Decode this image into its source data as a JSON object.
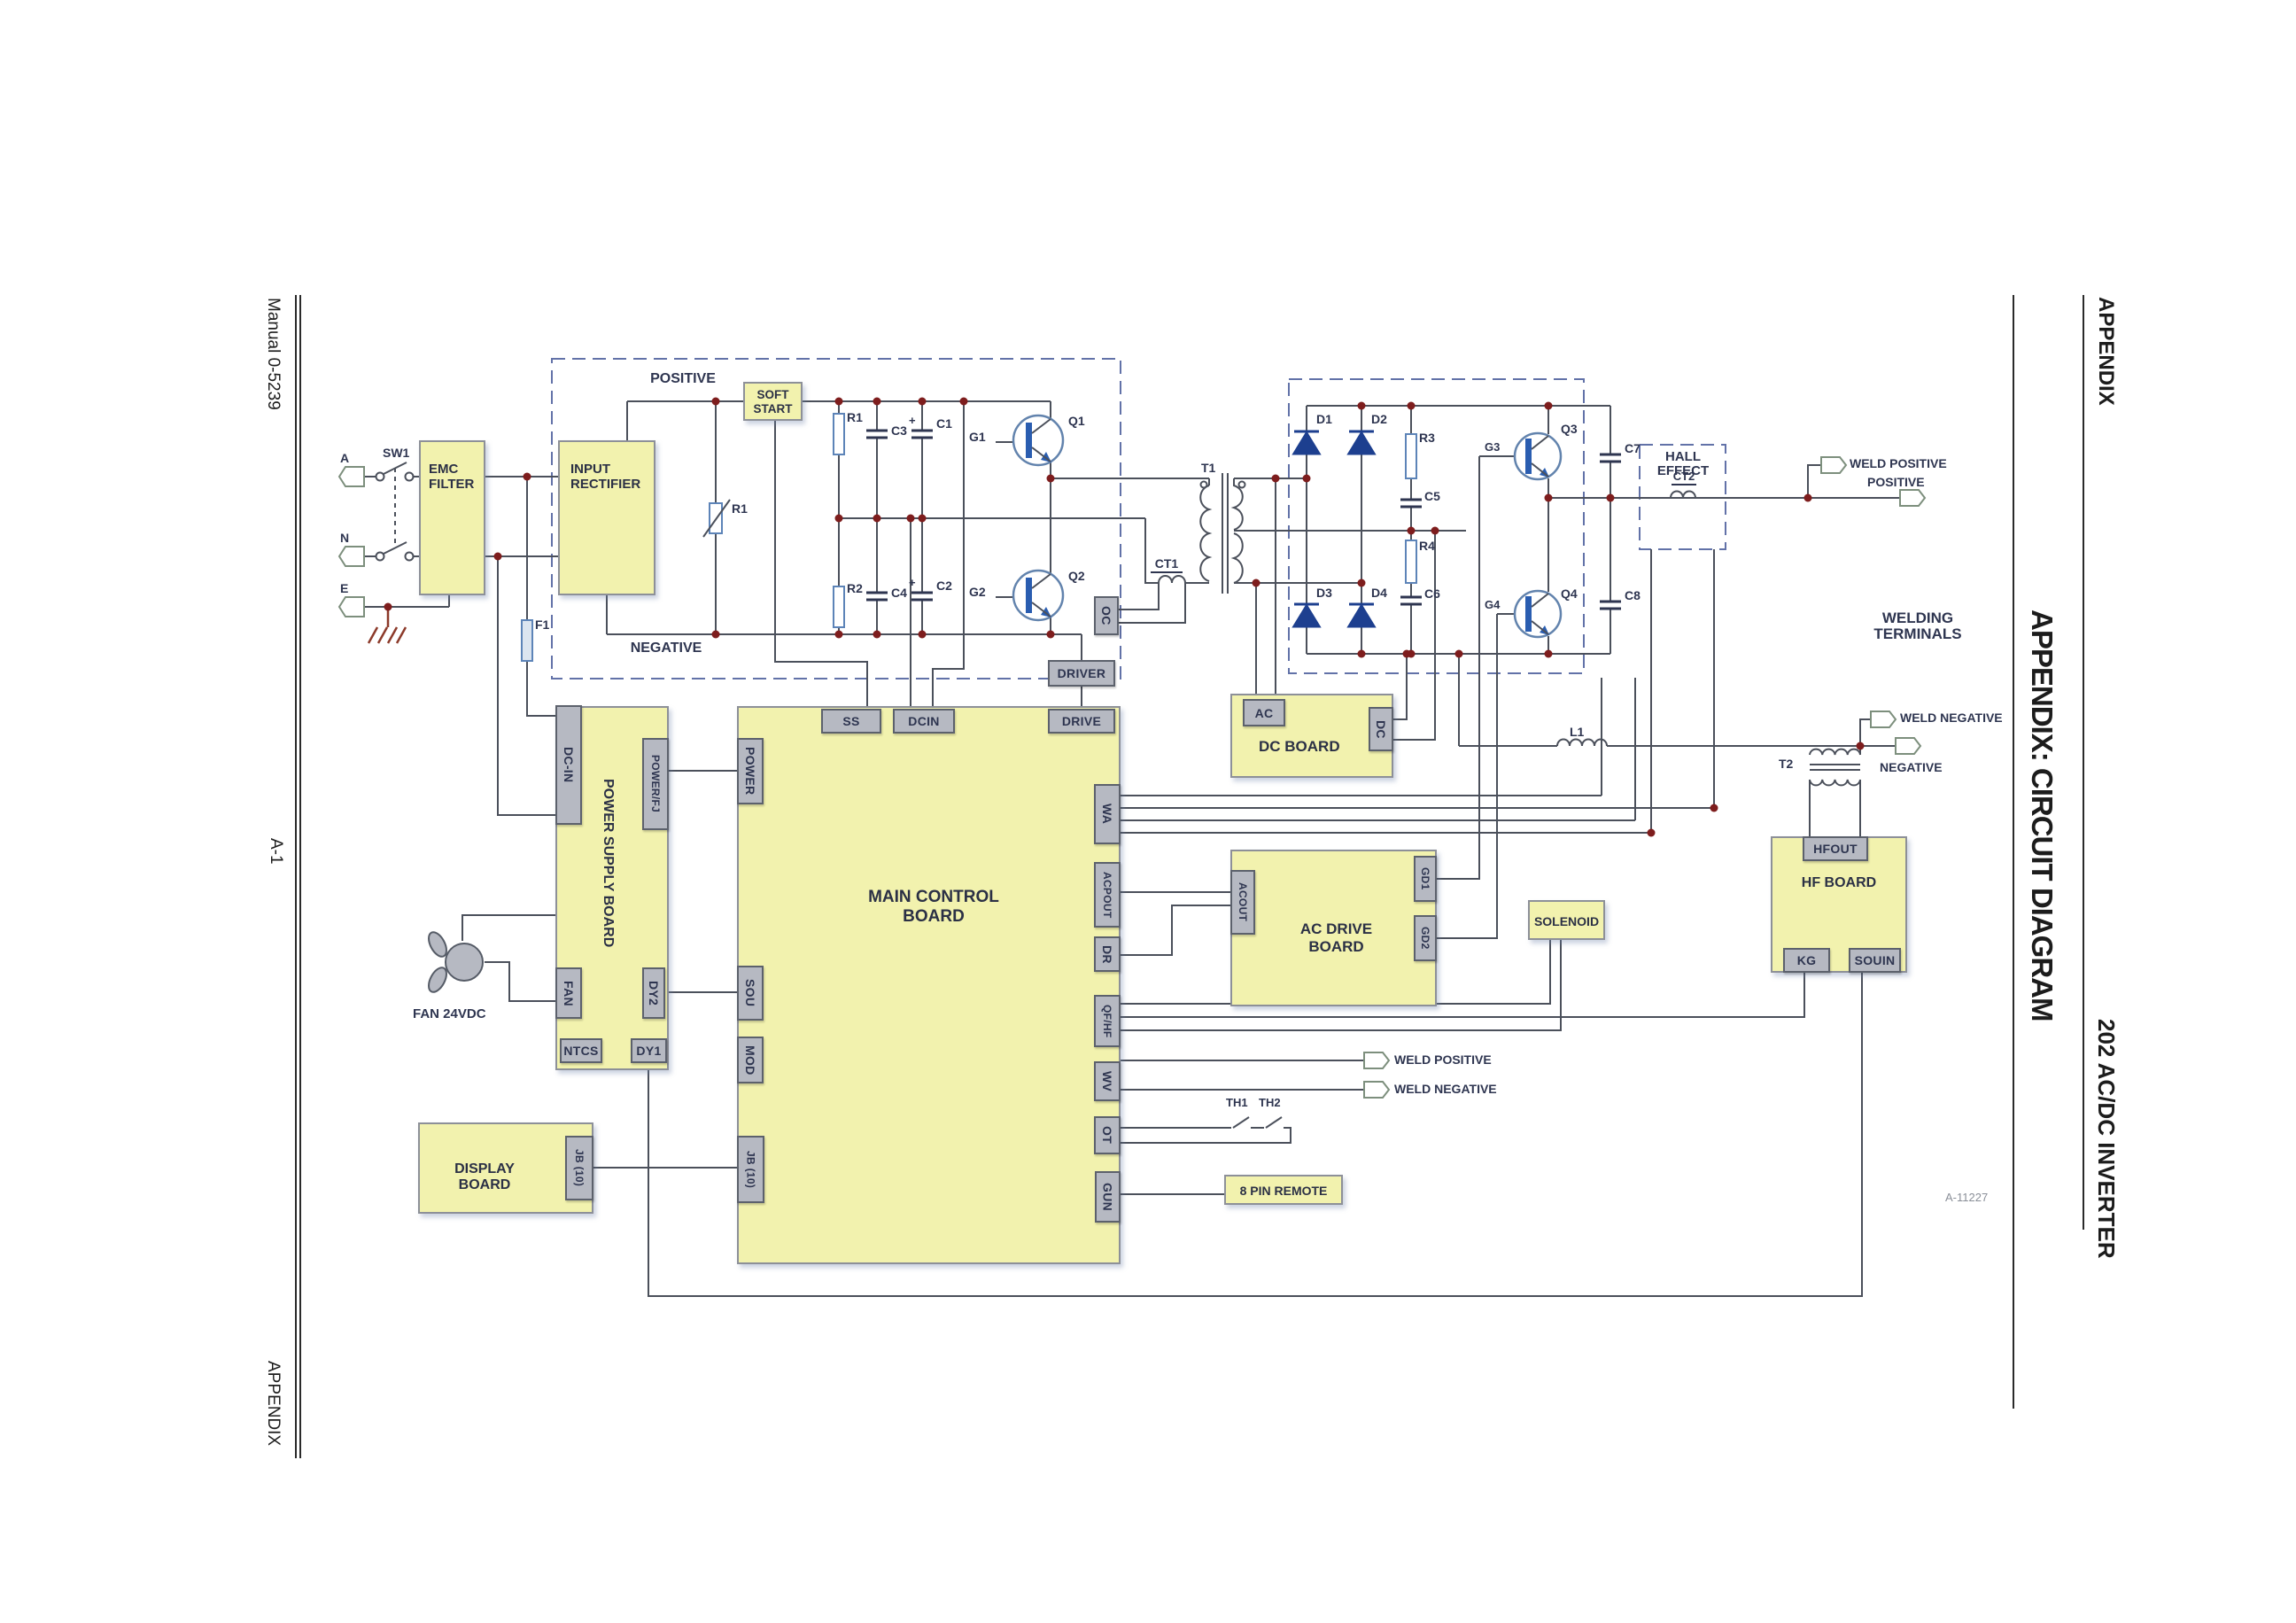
{
  "sidebars": {
    "left": {
      "top": "Manual 0-5239",
      "middle": "A-1",
      "bottom": "APPENDIX"
    },
    "right": {
      "header": "APPENDIX",
      "title": "APPENDIX: CIRCUIT DIAGRAM",
      "footer": "202 AC/DC INVERTER",
      "doc_code": "A-11227"
    }
  },
  "boards": {
    "emc_filter": "EMC\nFILTER",
    "input_rectifier": "INPUT\nRECTIFIER",
    "soft_start": "SOFT\nSTART",
    "main_control": "MAIN CONTROL BOARD",
    "power_supply": "POWER SUPPLY BOARD",
    "display": "DISPLAY BOARD",
    "dc": "DC BOARD",
    "ac_drive": "AC DRIVE BOARD",
    "hf": "HF BOARD",
    "solenoid": "SOLENOID",
    "remote": "8 PIN REMOTE"
  },
  "connectors": {
    "driver": "DRIVER",
    "oc": "OC",
    "ss": "SS",
    "dcin": "DCIN",
    "drive": "DRIVE",
    "power": "POWER",
    "sou": "SOU",
    "mod": "MOD",
    "jb10_main": "JB (10)",
    "wa": "WA",
    "acpout": "ACPOUT",
    "dr": "DR",
    "qfhf": "QF/HF",
    "wv": "WV",
    "ot": "OT",
    "gun": "GUN",
    "dc_in": "DC-IN",
    "power_fj": "POWER/FJ",
    "fan": "FAN",
    "ntcs": "NTCS",
    "dy1": "DY1",
    "dy2": "DY2",
    "jb10_display": "JB (10)",
    "ac": "AC",
    "dc": "DC",
    "acout": "ACOUT",
    "gd1": "GD1",
    "gd2": "GD2",
    "hfout": "HFOUT",
    "kg": "KG",
    "souin": "SOUIN"
  },
  "labels": {
    "a": "A",
    "n": "N",
    "e": "E",
    "sw1": "SW1",
    "f1": "F1",
    "positive": "POSITIVE",
    "negative": "NEGATIVE",
    "r1_varistor": "R1",
    "r1": "R1",
    "r2": "R2",
    "r3": "R3",
    "r4": "R4",
    "c1": "C1",
    "c2": "C2",
    "c3": "C3",
    "c4": "C4",
    "c5": "C5",
    "c6": "C6",
    "c7": "C7",
    "c8": "C8",
    "plus": "+",
    "q1": "Q1",
    "q2": "Q2",
    "q3": "Q3",
    "q4": "Q4",
    "g1": "G1",
    "g2": "G2",
    "g3": "G3",
    "g4": "G4",
    "d1": "D1",
    "d2": "D2",
    "d3": "D3",
    "d4": "D4",
    "t1": "T1",
    "t2": "T2",
    "ct1": "CT1",
    "ct2": "CT2",
    "l1": "L1",
    "th1": "TH1",
    "th2": "TH2",
    "hall_effect": "HALL EFFECT",
    "welding_terminals": "WELDING TERMINALS",
    "weld_positive": "WELD POSITIVE",
    "weld_negative": "WELD NEGATIVE",
    "positive_terminal": "POSITIVE",
    "negative_terminal": "NEGATIVE",
    "fan_24vdc": "FAN 24VDC"
  },
  "colors": {
    "board_fill": "#f2f2ae",
    "connector_fill": "#b6b9c2",
    "wire": "#4b505b",
    "dashed_box": "#6272a8",
    "junction": "#7e1d1d",
    "device_blue": "#2a5db0",
    "diode_blue": "#1d3f8f",
    "ground": "#8c3a2a"
  }
}
